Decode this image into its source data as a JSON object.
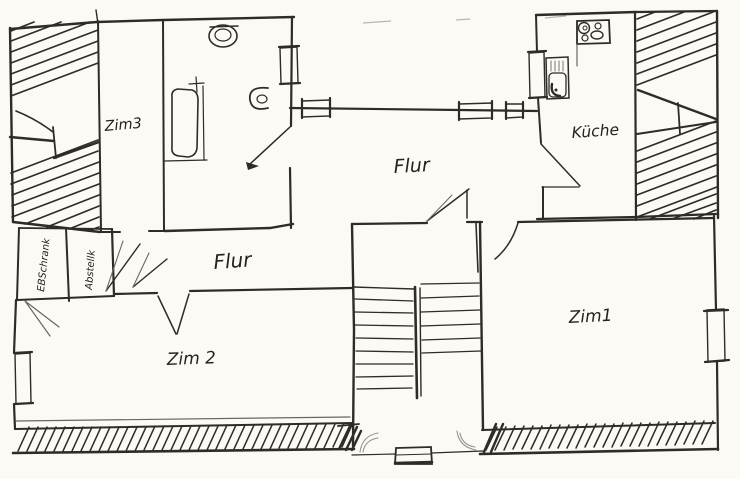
{
  "colors": {
    "ink": "#2f2b26",
    "faint_ink": "#6b675f",
    "paper": "#fbfaf5",
    "scan_gray": "#b9b6ae"
  },
  "rooms": {
    "zim3": "Zim3",
    "flur_upper": "Flur",
    "kueche": "Küche",
    "flur_lower": "Flur",
    "ebschrank": "EBSchrank",
    "abstellk": "Abstellk",
    "zim2": "Zim 2",
    "zim1": "Zim1"
  },
  "fixtures": {
    "bathtub": "bathtub",
    "toilet": "toilet",
    "washbasin": "washbasin",
    "stove": "stove with four burners",
    "kitchen_sink": "kitchen sink",
    "staircase": "u-shaped staircase",
    "entry_threshold": "entry door threshold",
    "roof_hatch": "hatched sloped-roof area",
    "exterior_wall_hatch": "hatched exterior wall"
  }
}
